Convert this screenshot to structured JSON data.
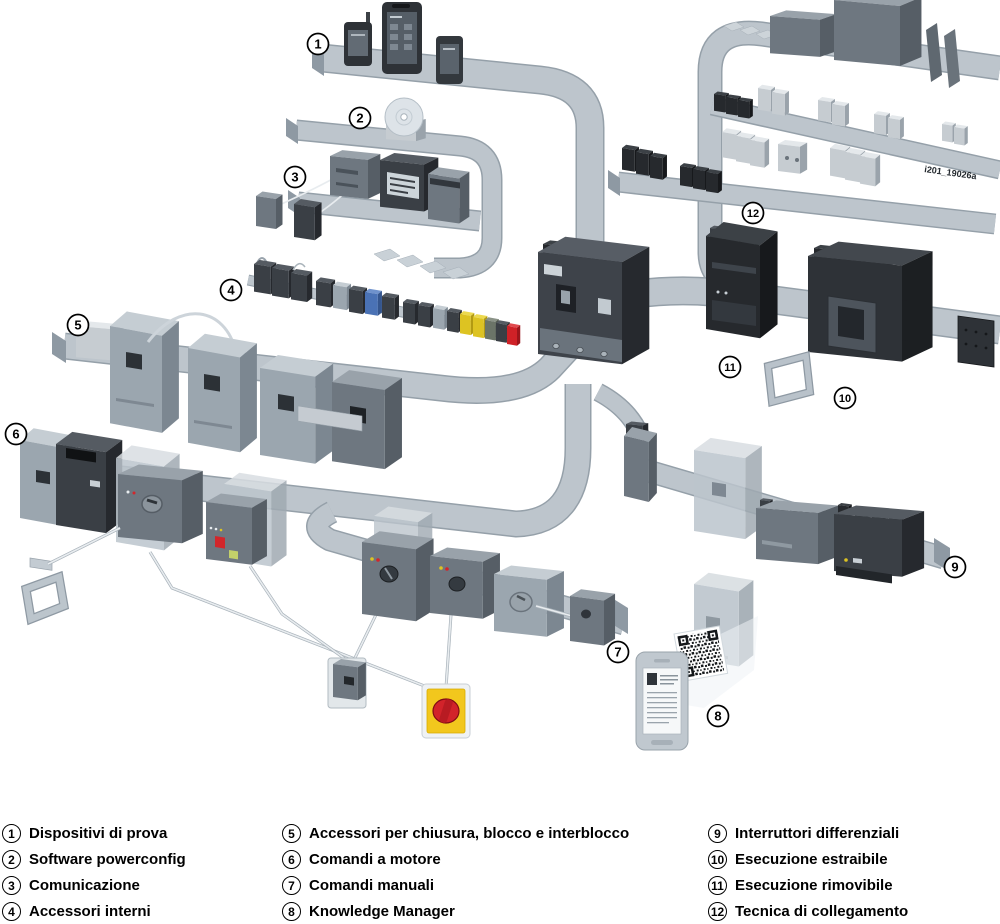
{
  "figure": {
    "image_id": "i201_19026a",
    "colors": {
      "rail": "#bdc5cc",
      "rail_edge": "#95a0a9",
      "device_dark": "#3a3f45",
      "device_light": "#9ba6af",
      "accent_red": "#cf2127",
      "accent_yellow": "#ddc322",
      "accent_blue": "#4a72b5",
      "emergency_handle_yellow": "#f2c71d",
      "emergency_handle_red": "#d2232a"
    }
  },
  "legend": {
    "items": [
      {
        "n": "1",
        "label": "Dispositivi di prova"
      },
      {
        "n": "2",
        "label": "Software powerconfig"
      },
      {
        "n": "3",
        "label": "Comunicazione"
      },
      {
        "n": "4",
        "label": "Accessori interni"
      },
      {
        "n": "5",
        "label": "Accessori per chiusura, blocco e interblocco"
      },
      {
        "n": "6",
        "label": "Comandi a motore"
      },
      {
        "n": "7",
        "label": "Comandi manuali"
      },
      {
        "n": "8",
        "label": "Knowledge Manager"
      },
      {
        "n": "9",
        "label": "Interruttori differenziali"
      },
      {
        "n": "10",
        "label": "Esecuzione estraibile"
      },
      {
        "n": "11",
        "label": "Esecuzione rimovibile"
      },
      {
        "n": "12",
        "label": "Tecnica di collegamento"
      }
    ]
  }
}
